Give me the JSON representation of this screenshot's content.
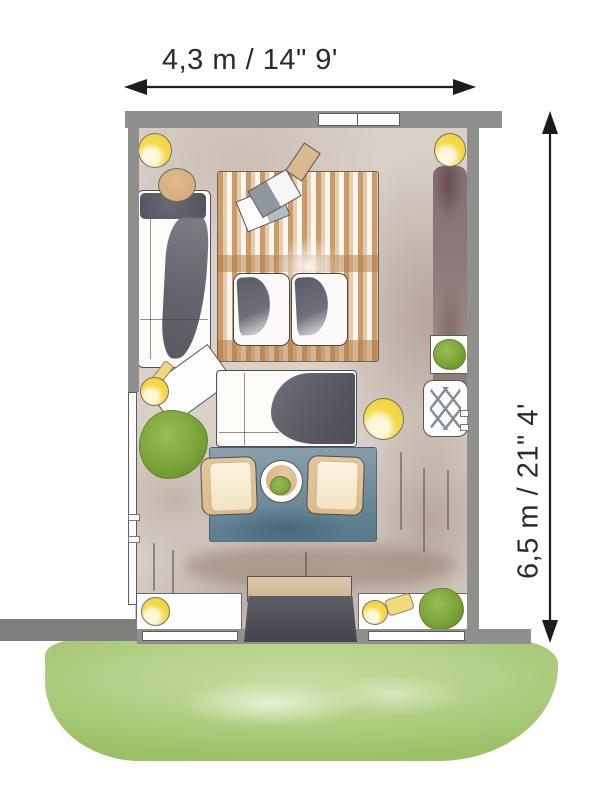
{
  "dimensions": {
    "width_label": "4,3 m / 14\" 9'",
    "height_label": "6,5 m / 21\" 4'"
  },
  "palette": {
    "ink": "#2b2b2b",
    "wall_gray": "#8e908e",
    "floor_taupe": "#d9d0c8",
    "rug_tan_stripe": "#c5945c",
    "rug_blue": "#6d8c9a",
    "accent_yellow": "#f5d94c",
    "plant_green": "#7aa338",
    "grass_green": "#b1cf84",
    "curtain_mauve": "#8e7a7a"
  },
  "floorplan_items": [
    "ceiling-lamp-top-left",
    "ceiling-lamp-top-right",
    "round-side-table",
    "sectional-sofa",
    "striped-tan-rug",
    "open-magazine",
    "note-card",
    "lounge-chair-left",
    "lounge-chair-right",
    "desk-lamp",
    "angled-side-table",
    "shrub-left",
    "center-sofa",
    "floor-lamp",
    "potted-plant",
    "lattice-side-table",
    "curtain-panel",
    "blue-area-rug",
    "armchair-left",
    "armchair-right",
    "round-coffee-table",
    "console-table",
    "doormat",
    "window-bench-left",
    "window-bench-right",
    "table-lamp-bottom-left",
    "table-lamp-bottom-right",
    "shrub-bottom-right",
    "lawn"
  ]
}
